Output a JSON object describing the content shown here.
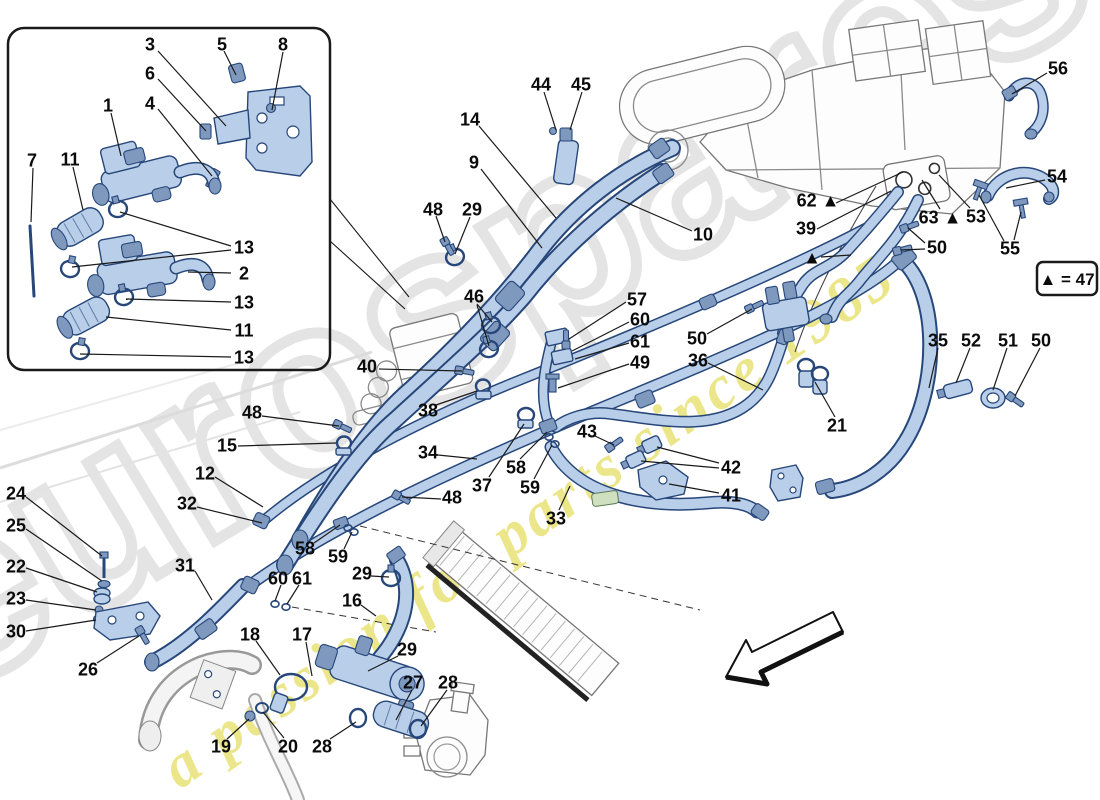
{
  "watermark": {
    "brand": "eurospares",
    "tagline": "a passion for parts since 1985"
  },
  "legend": {
    "text": "▲ = 47"
  },
  "colors": {
    "pipe_fill": "#b9cee8",
    "pipe_outline": "#27477a",
    "watermark_yellow": "#e9e276",
    "watermark_gray": "#e4e4e4",
    "label": "#0b0b0b",
    "background": "#ffffff"
  },
  "callouts": [
    {
      "t": "3",
      "x": 150,
      "y": 44,
      "l": [
        [
          158,
          51,
          226,
          126
        ]
      ]
    },
    {
      "t": "5",
      "x": 222,
      "y": 44,
      "l": [
        [
          224,
          51,
          236,
          75
        ]
      ]
    },
    {
      "t": "8",
      "x": 283,
      "y": 44,
      "l": [
        [
          283,
          52,
          272,
          110
        ]
      ]
    },
    {
      "t": "6",
      "x": 150,
      "y": 73,
      "l": [
        [
          158,
          79,
          206,
          131
        ]
      ]
    },
    {
      "t": "4",
      "x": 150,
      "y": 103,
      "l": [
        [
          158,
          109,
          212,
          176
        ]
      ]
    },
    {
      "t": "1",
      "x": 108,
      "y": 105,
      "l": [
        [
          111,
          113,
          121,
          156
        ]
      ]
    },
    {
      "t": "7",
      "x": 32,
      "y": 160,
      "l": [
        [
          33,
          168,
          31,
          222
        ]
      ]
    },
    {
      "t": "11",
      "x": 70,
      "y": 159,
      "l": [
        [
          73,
          167,
          83,
          210
        ]
      ]
    },
    {
      "t": "13",
      "x": 244,
      "y": 247,
      "l": [
        [
          231,
          246,
          120,
          212
        ],
        [
          231,
          250,
          72,
          267
        ]
      ]
    },
    {
      "t": "2",
      "x": 244,
      "y": 273,
      "l": [
        [
          231,
          273,
          188,
          272
        ]
      ]
    },
    {
      "t": "13",
      "x": 244,
      "y": 302,
      "l": [
        [
          231,
          302,
          126,
          299
        ]
      ]
    },
    {
      "t": "11",
      "x": 244,
      "y": 330,
      "l": [
        [
          231,
          330,
          106,
          317
        ]
      ]
    },
    {
      "t": "13",
      "x": 244,
      "y": 357,
      "l": [
        [
          231,
          357,
          80,
          354
        ]
      ]
    },
    {
      "t": "44",
      "x": 541,
      "y": 84,
      "l": [
        [
          544,
          92,
          556,
          130
        ]
      ]
    },
    {
      "t": "45",
      "x": 581,
      "y": 84,
      "l": [
        [
          582,
          92,
          570,
          130
        ]
      ]
    },
    {
      "t": "14",
      "x": 470,
      "y": 119,
      "l": [
        [
          479,
          126,
          556,
          218
        ]
      ]
    },
    {
      "t": "9",
      "x": 474,
      "y": 162,
      "l": [
        [
          481,
          169,
          542,
          248
        ]
      ]
    },
    {
      "t": "10",
      "x": 703,
      "y": 234,
      "l": [
        [
          692,
          231,
          616,
          198
        ]
      ]
    },
    {
      "t": "56",
      "x": 1058,
      "y": 68,
      "l": [
        [
          1047,
          73,
          1012,
          94
        ]
      ]
    },
    {
      "t": "54",
      "x": 1057,
      "y": 176,
      "l": [
        [
          1045,
          180,
          1006,
          188
        ]
      ]
    },
    {
      "t": "55",
      "x": 1010,
      "y": 248,
      "l": [
        [
          1004,
          241,
          979,
          195
        ],
        [
          1014,
          240,
          1021,
          212
        ]
      ]
    },
    {
      "t": "62 ▲",
      "x": 818,
      "y": 200,
      "l": [
        [
          836,
          203,
          903,
          172
        ]
      ]
    },
    {
      "t": "39",
      "x": 806,
      "y": 228,
      "l": [
        [
          817,
          229,
          891,
          191
        ]
      ]
    },
    {
      "t": "▲",
      "x": 812,
      "y": 257,
      "l": [
        [
          821,
          257,
          851,
          255
        ]
      ]
    },
    {
      "t": "63 ▲",
      "x": 940,
      "y": 217,
      "l": [
        [
          940,
          209,
          922,
          180
        ]
      ]
    },
    {
      "t": "53",
      "x": 976,
      "y": 216,
      "l": [
        [
          970,
          208,
          939,
          175
        ]
      ]
    },
    {
      "t": "50",
      "x": 937,
      "y": 247,
      "l": [
        [
          925,
          243,
          908,
          228
        ],
        [
          925,
          249,
          901,
          250
        ]
      ]
    },
    {
      "t": "48",
      "x": 433,
      "y": 209,
      "l": [
        [
          436,
          216,
          445,
          242
        ]
      ]
    },
    {
      "t": "29",
      "x": 472,
      "y": 209,
      "l": [
        [
          470,
          217,
          455,
          254
        ]
      ]
    },
    {
      "t": "46",
      "x": 474,
      "y": 296,
      "l": [
        [
          477,
          304,
          492,
          322
        ],
        [
          477,
          305,
          489,
          346
        ]
      ]
    },
    {
      "t": "57",
      "x": 637,
      "y": 299,
      "l": [
        [
          626,
          302,
          569,
          339
        ]
      ]
    },
    {
      "t": "60",
      "x": 640,
      "y": 319,
      "l": [
        [
          629,
          322,
          572,
          351
        ]
      ]
    },
    {
      "t": "61",
      "x": 640,
      "y": 341,
      "l": [
        [
          629,
          343,
          575,
          359
        ]
      ]
    },
    {
      "t": "49",
      "x": 640,
      "y": 362,
      "l": [
        [
          629,
          364,
          558,
          388
        ]
      ]
    },
    {
      "t": "40",
      "x": 367,
      "y": 366,
      "l": [
        [
          379,
          369,
          462,
          371
        ]
      ]
    },
    {
      "t": "38",
      "x": 428,
      "y": 410,
      "l": [
        [
          436,
          405,
          477,
          391
        ]
      ]
    },
    {
      "t": "50",
      "x": 697,
      "y": 338,
      "l": [
        [
          707,
          334,
          752,
          309
        ]
      ]
    },
    {
      "t": "36",
      "x": 698,
      "y": 360,
      "l": [
        [
          708,
          363,
          763,
          390
        ]
      ]
    },
    {
      "t": "34",
      "x": 428,
      "y": 452,
      "l": [
        [
          438,
          455,
          477,
          459
        ]
      ]
    },
    {
      "t": "37",
      "x": 482,
      "y": 485,
      "l": [
        [
          489,
          477,
          524,
          424
        ]
      ]
    },
    {
      "t": "58",
      "x": 516,
      "y": 467,
      "l": [
        [
          520,
          459,
          547,
          432
        ]
      ]
    },
    {
      "t": "59",
      "x": 530,
      "y": 487,
      "l": [
        [
          534,
          479,
          552,
          445
        ]
      ]
    },
    {
      "t": "43",
      "x": 587,
      "y": 431,
      "l": [
        [
          595,
          436,
          614,
          445
        ]
      ]
    },
    {
      "t": "42",
      "x": 731,
      "y": 467,
      "l": [
        [
          719,
          463,
          657,
          447
        ],
        [
          719,
          468,
          641,
          461
        ]
      ]
    },
    {
      "t": "41",
      "x": 731,
      "y": 495,
      "l": [
        [
          719,
          493,
          669,
          484
        ]
      ]
    },
    {
      "t": "33",
      "x": 556,
      "y": 518,
      "l": [
        [
          559,
          510,
          570,
          486
        ]
      ]
    },
    {
      "t": "15",
      "x": 227,
      "y": 445,
      "l": [
        [
          238,
          446,
          336,
          443
        ]
      ]
    },
    {
      "t": "48",
      "x": 252,
      "y": 412,
      "l": [
        [
          262,
          416,
          339,
          426
        ]
      ]
    },
    {
      "t": "48",
      "x": 452,
      "y": 497,
      "l": [
        [
          441,
          499,
          402,
          497
        ]
      ]
    },
    {
      "t": "12",
      "x": 205,
      "y": 473,
      "l": [
        [
          215,
          477,
          263,
          507
        ]
      ]
    },
    {
      "t": "32",
      "x": 187,
      "y": 503,
      "l": [
        [
          197,
          507,
          262,
          523
        ]
      ]
    },
    {
      "t": "31",
      "x": 185,
      "y": 565,
      "l": [
        [
          195,
          571,
          212,
          600
        ]
      ]
    },
    {
      "t": "24",
      "x": 16,
      "y": 493,
      "l": [
        [
          26,
          497,
          102,
          556
        ]
      ]
    },
    {
      "t": "25",
      "x": 16,
      "y": 525,
      "l": [
        [
          26,
          529,
          102,
          581
        ]
      ]
    },
    {
      "t": "22",
      "x": 16,
      "y": 566,
      "l": [
        [
          26,
          568,
          97,
          592
        ]
      ]
    },
    {
      "t": "23",
      "x": 16,
      "y": 598,
      "l": [
        [
          26,
          600,
          96,
          610
        ]
      ]
    },
    {
      "t": "30",
      "x": 16,
      "y": 631,
      "l": [
        [
          26,
          631,
          96,
          620
        ]
      ]
    },
    {
      "t": "26",
      "x": 88,
      "y": 669,
      "l": [
        [
          97,
          663,
          139,
          636
        ]
      ]
    },
    {
      "t": "58",
      "x": 305,
      "y": 548,
      "l": [
        [
          314,
          543,
          340,
          525
        ]
      ]
    },
    {
      "t": "59",
      "x": 338,
      "y": 556,
      "l": [
        [
          344,
          549,
          352,
          532
        ]
      ]
    },
    {
      "t": "60",
      "x": 278,
      "y": 578,
      "l": [
        [
          281,
          585,
          275,
          601
        ]
      ]
    },
    {
      "t": "61",
      "x": 302,
      "y": 578,
      "l": [
        [
          299,
          585,
          287,
          604
        ]
      ]
    },
    {
      "t": "29",
      "x": 362,
      "y": 573,
      "l": [
        [
          371,
          576,
          389,
          577
        ]
      ]
    },
    {
      "t": "16",
      "x": 352,
      "y": 600,
      "l": [
        [
          361,
          605,
          376,
          616
        ]
      ]
    },
    {
      "t": "18",
      "x": 250,
      "y": 634,
      "l": [
        [
          256,
          641,
          280,
          675
        ]
      ]
    },
    {
      "t": "17",
      "x": 302,
      "y": 634,
      "l": [
        [
          306,
          642,
          312,
          676
        ]
      ]
    },
    {
      "t": "29",
      "x": 407,
      "y": 649,
      "l": [
        [
          398,
          656,
          368,
          671
        ]
      ]
    },
    {
      "t": "27",
      "x": 413,
      "y": 682,
      "l": [
        [
          412,
          690,
          396,
          720
        ]
      ]
    },
    {
      "t": "28",
      "x": 448,
      "y": 682,
      "l": [
        [
          447,
          690,
          421,
          726
        ]
      ]
    },
    {
      "t": "19",
      "x": 221,
      "y": 746,
      "l": [
        [
          227,
          739,
          249,
          719
        ]
      ]
    },
    {
      "t": "20",
      "x": 288,
      "y": 746,
      "l": [
        [
          284,
          738,
          263,
          712
        ]
      ]
    },
    {
      "t": "28",
      "x": 322,
      "y": 746,
      "l": [
        [
          330,
          739,
          356,
          722
        ]
      ]
    },
    {
      "t": "35",
      "x": 938,
      "y": 340,
      "l": [
        [
          938,
          348,
          929,
          388
        ]
      ]
    },
    {
      "t": "52",
      "x": 971,
      "y": 340,
      "l": [
        [
          970,
          348,
          956,
          383
        ]
      ]
    },
    {
      "t": "51",
      "x": 1008,
      "y": 340,
      "l": [
        [
          1007,
          348,
          993,
          390
        ]
      ]
    },
    {
      "t": "50",
      "x": 1041,
      "y": 340,
      "l": [
        [
          1040,
          348,
          1015,
          396
        ]
      ]
    },
    {
      "t": "21",
      "x": 837,
      "y": 425,
      "l": [
        [
          835,
          417,
          815,
          382
        ]
      ]
    }
  ]
}
